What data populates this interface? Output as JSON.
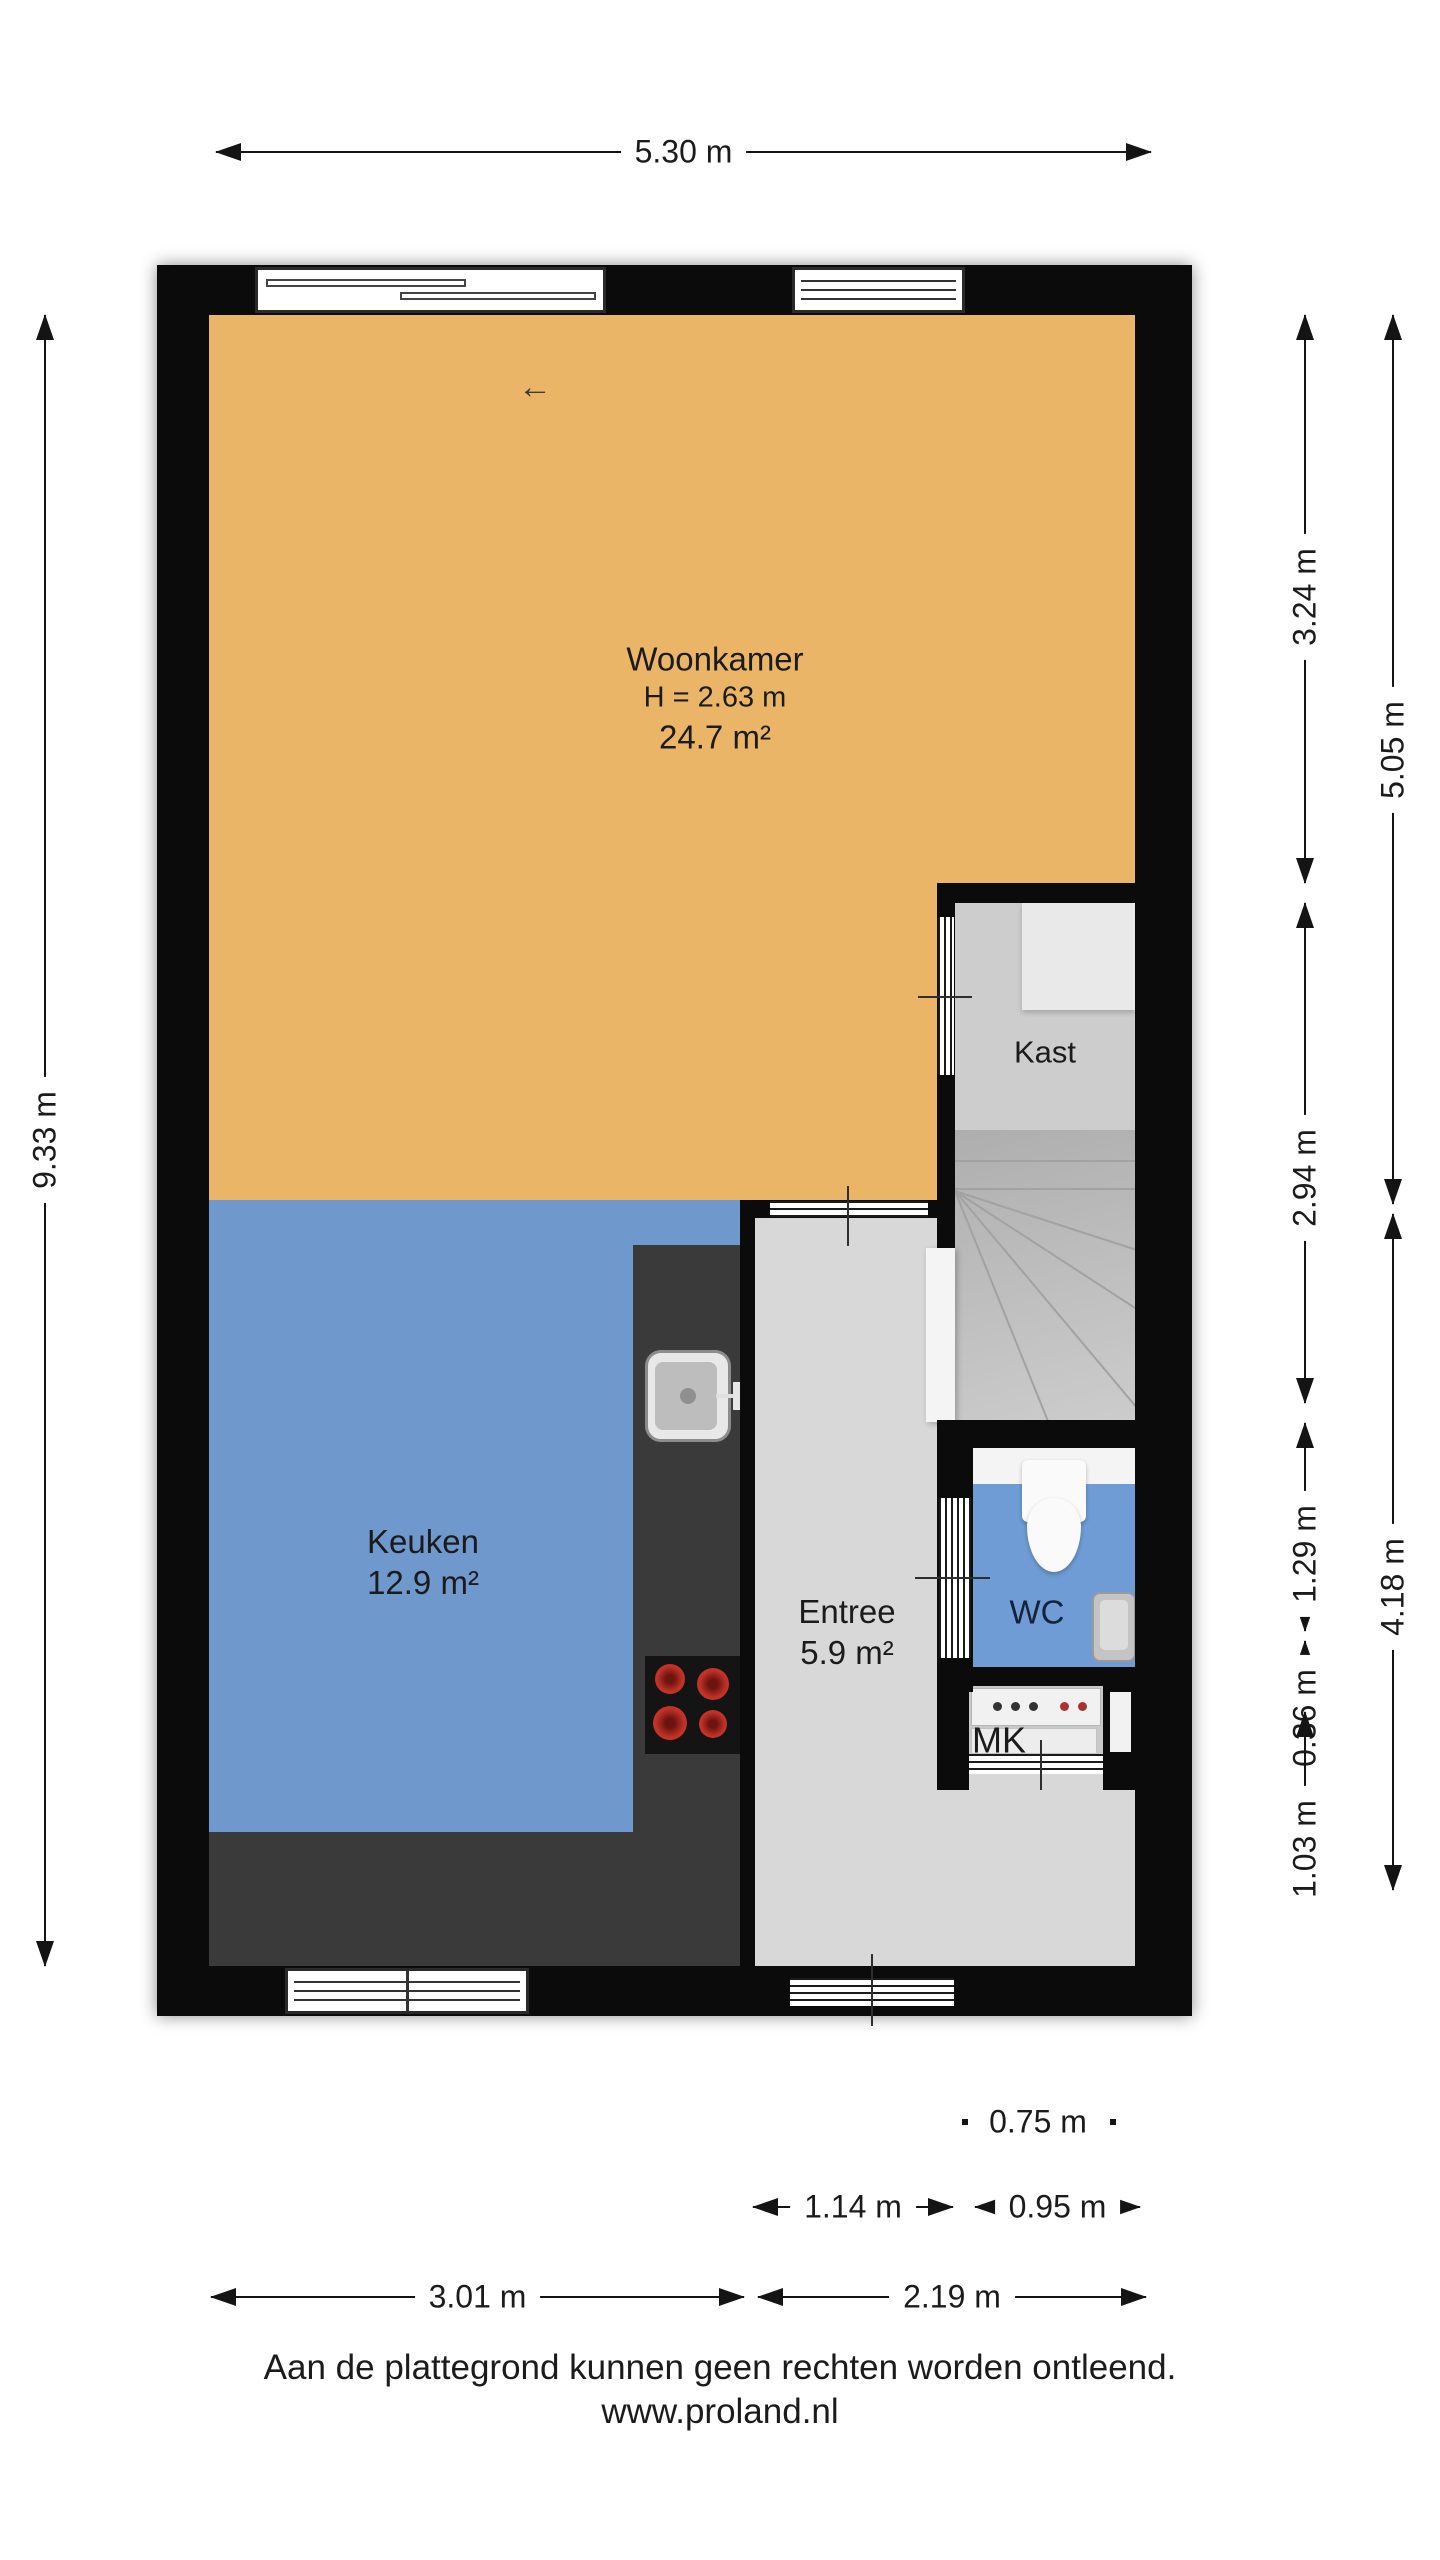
{
  "rooms": {
    "woonkamer": {
      "name": "Woonkamer",
      "ceiling": "H = 2.63 m",
      "area": "24.7 m²"
    },
    "keuken": {
      "name": "Keuken",
      "area": "12.9 m²"
    },
    "entree": {
      "name": "Entree",
      "area": "5.9 m²"
    },
    "kast": {
      "name": "Kast"
    },
    "wc": {
      "name": "WC"
    },
    "mk": {
      "name": "MK"
    }
  },
  "dimensions": {
    "top_width": "5.30 m",
    "left_height": "9.33 m",
    "right_inner": [
      "3.24 m",
      "2.94 m",
      "1.29 m",
      "0.36 m",
      "1.03 m"
    ],
    "right_outer": [
      "5.05 m",
      "4.18 m"
    ],
    "bottom": [
      "0.75 m",
      "1.14 m",
      "0.95 m",
      "3.01 m",
      "2.19 m"
    ]
  },
  "icons": {
    "slide_arrow": "←"
  },
  "footer": {
    "disclaimer": "Aan de plattegrond kunnen geen rechten worden ontleend.",
    "website": "www.proland.nl"
  },
  "colors": {
    "woonkamer_fill": "#ebb567",
    "keuken_fill": "#6f98cc",
    "wc_fill": "#6f9cd4",
    "entree_fill": "#d8d8d8",
    "counter": "#3a3a3a",
    "wall": "#0b0b0b",
    "burner_red": "#c23228"
  }
}
